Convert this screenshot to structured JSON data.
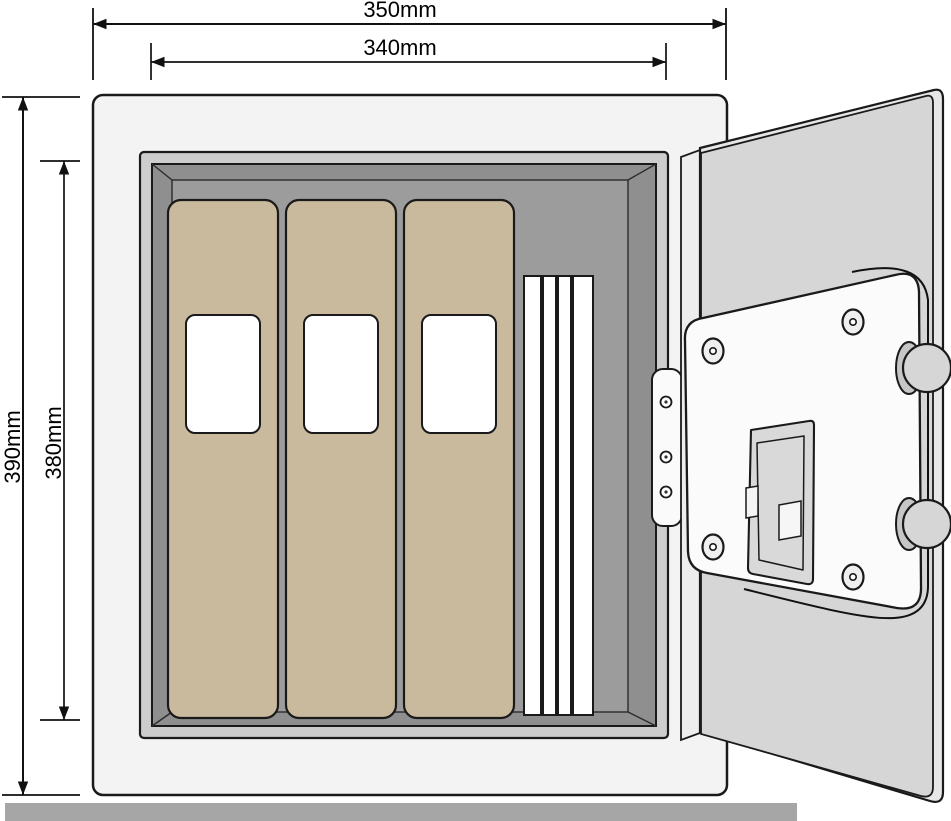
{
  "dimensions": {
    "outer_width": "350mm",
    "inner_width": "340mm",
    "outer_height": "390mm",
    "inner_height": "380mm"
  },
  "objects": {
    "binders": 3,
    "file_folders": 4,
    "door_screws": 4,
    "hinge_pins": 3,
    "locking_bolts": 2
  },
  "colors": {
    "outline": "#1a1a1a",
    "safe_body": "#f4f3f3",
    "door_jamb": "#cdcdcd",
    "interior": "#8f8f8f",
    "interior_back": "#9c9c9c",
    "binder": "#c9ba9d",
    "binder_label": "#ffffff",
    "folder": "#ffffff",
    "door_back": "#e7e7e7",
    "door_panel": "#d6d6d6",
    "door_edge": "#ededed",
    "hinge_plate": "#fafafa",
    "lock_plate": "#fbfbfb",
    "battery_cover": "#d9d9d9",
    "bolt_front": "#d6d6d6",
    "bolt_back": "#c6c6c6",
    "floor": "#a6a6a6",
    "dimension_line": "#111111"
  }
}
